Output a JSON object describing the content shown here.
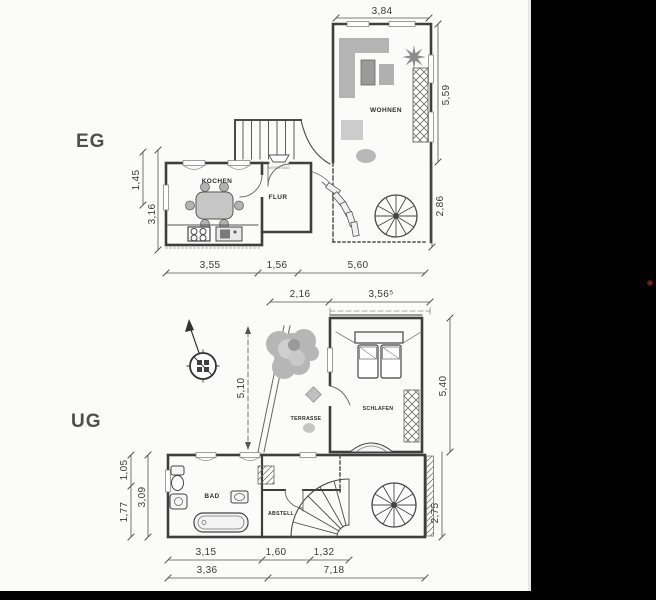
{
  "colors": {
    "paper": "#fbfbfa",
    "ink": "#3e3e3e",
    "furniture_gray": "#b6b6b6",
    "scan_margin": "#000000",
    "red_dot": "#6b1a1a"
  },
  "eg": {
    "floor_label": "EG",
    "rooms": {
      "wohnen": "WOHNEN",
      "kochen": "KOCHEN",
      "flur": "FLUR",
      "windfang": "WINDFANG"
    },
    "dims": {
      "top_width": "3,84",
      "right_upper": "5,59",
      "right_lower": "2,86",
      "left_upper": "1,45",
      "left_lower": "3,16",
      "bottom_left": "3,55",
      "bottom_mid": "1,56",
      "bottom_right": "5,60"
    }
  },
  "ug": {
    "floor_label": "UG",
    "rooms": {
      "terrasse": "TERRASSE",
      "schlafen": "SCHLAFEN",
      "bad": "BAD",
      "abstell": "ABSTELL"
    },
    "dims": {
      "top_left": "2,16",
      "top_right": "3,56⁵",
      "terrace_height": "5,10",
      "right_upper": "5,40",
      "right_lower": "2,75",
      "left_top": "1,05",
      "left_mid": "1,77",
      "left_inner": "3,09",
      "bottom_a": "3,15",
      "bottom_b": "1,60",
      "bottom_c": "1,32",
      "bottom_total_left": "3,36",
      "bottom_total_right": "7,18"
    }
  }
}
